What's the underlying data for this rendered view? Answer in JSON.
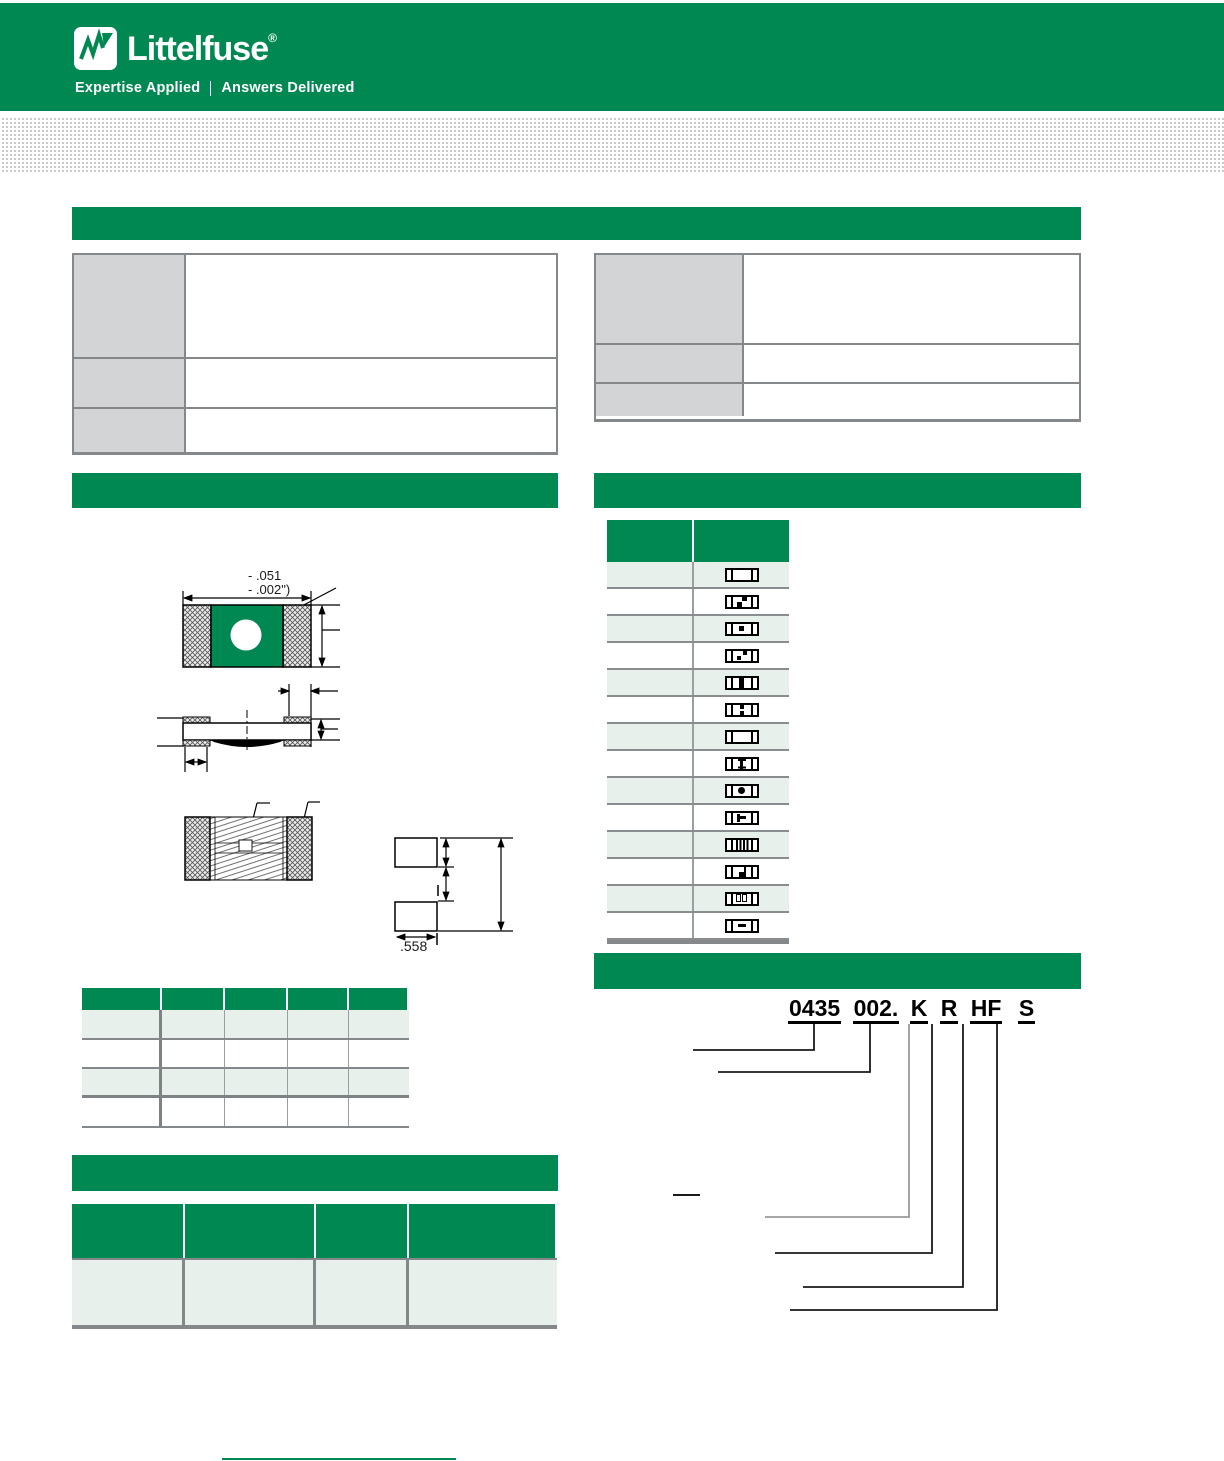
{
  "header": {
    "logo_text": "Littelfuse",
    "registered_mark": "®",
    "tagline_left": "Expertise Applied",
    "tagline_right": "Answers Delivered"
  },
  "diagram": {
    "dim_width_line1": "- .051",
    "dim_width_line2": "- .002\")",
    "pad_width_label": ".558"
  },
  "part_numbering": {
    "example_segments": [
      "0435",
      "002.",
      "K",
      "R",
      "HF",
      "S"
    ]
  },
  "marking_table": {
    "marks": [
      "plain",
      "offset-squares",
      "square",
      "diagonal-squares",
      "thick-bar",
      "colon",
      "plain",
      "ibeam",
      "dot",
      "tee-right",
      "stripes",
      "corner",
      "two-rects",
      "dash"
    ]
  },
  "colors": {
    "brand_green": "#008852",
    "light_row": "#e7f0eb",
    "gray_cell": "#d2d4d5",
    "table_border": "#85888a",
    "dot_gray": "#c8c9cb"
  }
}
